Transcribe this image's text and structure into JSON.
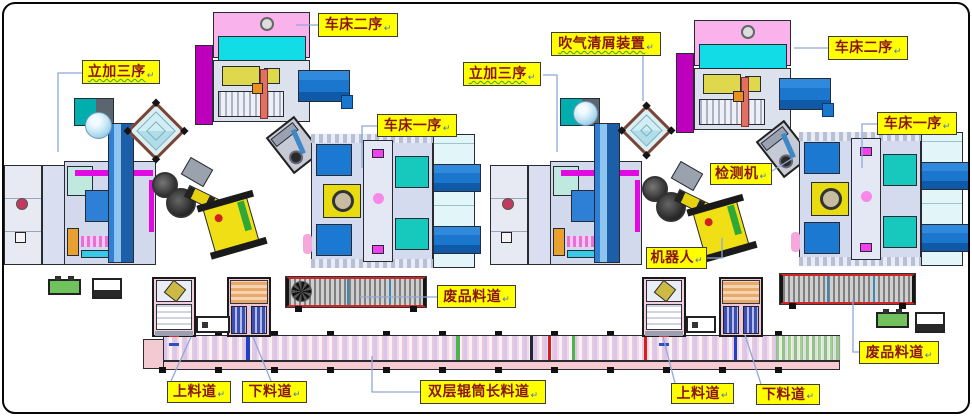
{
  "diagram_title": "automated machining line layout",
  "return_mark": "↵",
  "palette": {
    "label_bg": "#FFFF00",
    "label_text": "#8B1414",
    "label_border": "#3C3C3C",
    "leader_line": "#8FA8D8",
    "machine_pink": "#F9B2EC",
    "machine_cyan": "#12DCE6",
    "magenta_slab": "#BC00BC",
    "conveyor_blue": "#1B76CE",
    "body_lavender": "#D5DBEE",
    "teal_block": "#17C9BC",
    "robot_yellow": "#EFDF14",
    "scrap_red_edge": "#CF2626",
    "long_conveyor_pink": "#F6CBD1",
    "green_box": "#6FC25C"
  },
  "labels": [
    {
      "id": "lathe-op2-left",
      "text": "车床二序"
    },
    {
      "id": "vmc-op3-left",
      "text": "立加三序"
    },
    {
      "id": "blow-clean",
      "text": "吹气清屑装置"
    },
    {
      "id": "vmc-op3-right",
      "text": "立加三序"
    },
    {
      "id": "lathe-op2-right",
      "text": "车床二序"
    },
    {
      "id": "lathe-op1-left",
      "text": "车床一序"
    },
    {
      "id": "lathe-op1-right",
      "text": "车床一序"
    },
    {
      "id": "inspection",
      "text": "检测机"
    },
    {
      "id": "robot",
      "text": "机器人"
    },
    {
      "id": "scrap-left",
      "text": "废品料道"
    },
    {
      "id": "scrap-right",
      "text": "废品料道"
    },
    {
      "id": "load-left",
      "text": "上料道"
    },
    {
      "id": "unload-left",
      "text": "下料道"
    },
    {
      "id": "long-conveyor",
      "text": "双层辊筒长料道"
    },
    {
      "id": "load-right",
      "text": "上料道"
    },
    {
      "id": "unload-right",
      "text": "下料道"
    }
  ]
}
